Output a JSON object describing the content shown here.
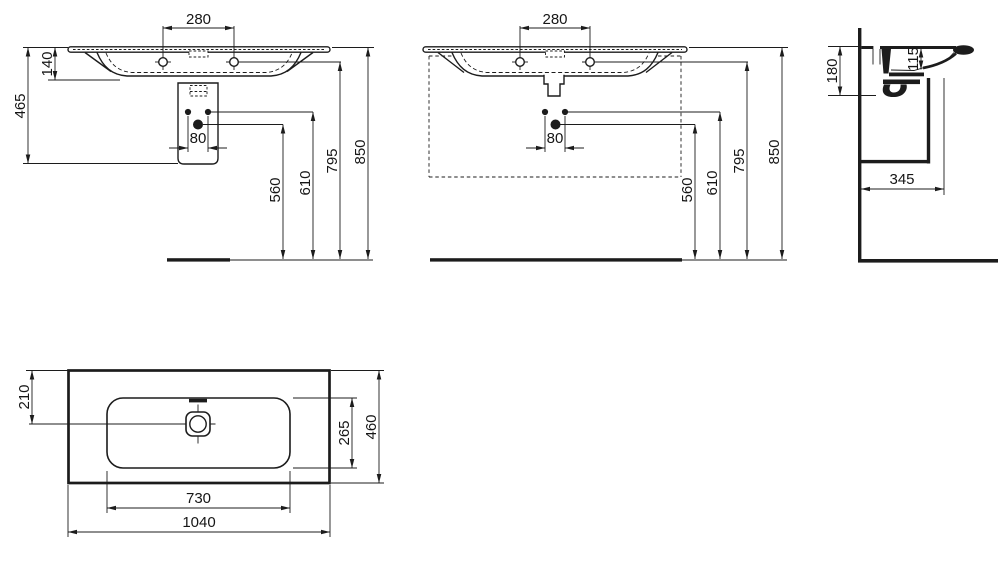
{
  "drawing": {
    "kind": "washbasin installation drawing",
    "unit": "mm",
    "background": "#ffffff",
    "line_color": "#1c1c1c"
  },
  "views": {
    "front_trap": {
      "label": "front view with trap cover",
      "dims": {
        "tap_spacing": "280",
        "rim_to_bowl": "140",
        "overall_height": "465",
        "fixing_spacing": "80",
        "waste_height": "560",
        "fixing_height": "610",
        "tap_level": "795",
        "rim_level": "850"
      }
    },
    "front_furniture": {
      "label": "front view with furniture outline",
      "dims": {
        "tap_spacing": "280",
        "fixing_spacing": "80",
        "waste_height": "560",
        "fixing_height": "610",
        "tap_level": "795",
        "rim_level": "850"
      }
    },
    "side_section": {
      "label": "side section view",
      "dims": {
        "front_height": "180",
        "bowl_depth": "115",
        "depth_from_wall": "345"
      }
    },
    "plan": {
      "label": "plan view",
      "dims": {
        "waste_from_front": "210",
        "bowl_depth": "265",
        "overall_depth": "460",
        "bowl_width": "730",
        "overall_width": "1040"
      }
    }
  }
}
